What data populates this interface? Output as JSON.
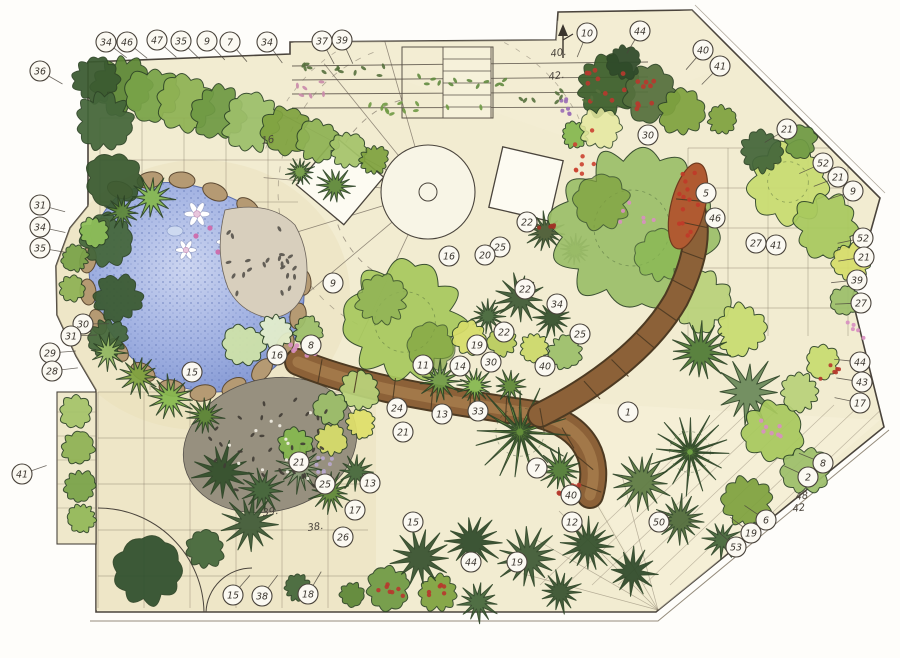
{
  "document": {
    "kind": "hand-drawn watercolor garden landscape plan"
  },
  "colors": {
    "paper": "#fefdfa",
    "plan_paving": "#f2ecd1",
    "sand": "#e9ddb4",
    "ink": "#4a443c",
    "pond_water": "#93a6dc",
    "stone_edging": "#b59a73",
    "pebble_dark": "#403c35",
    "path_brown": "#8c6138",
    "cobble_rust": "#b05a31",
    "foliage_light": "#c9dc71",
    "foliage_mid": "#7fa23f",
    "foliage_dark": "#2f4a2a",
    "flower_red": "#b63a2e",
    "flower_pink": "#d88fc0",
    "flower_purple": "#9b6fb5"
  },
  "features": [
    "pond-with-stone-edging",
    "water-lilies",
    "pebble-mosaic-beds",
    "central-circular-patio",
    "round-table",
    "two-square-platforms",
    "curved-stepping-stone-path",
    "rust-cobble-path",
    "pergola-with-climbers",
    "trellis-panel",
    "garden-gate-swing-arcs",
    "perimeter-planting-beds"
  ],
  "labels": {
    "circled": [
      {
        "n": "34",
        "x": 106,
        "y": 42,
        "e": 1
      },
      {
        "n": "46",
        "x": 127,
        "y": 42,
        "e": 1
      },
      {
        "n": "47",
        "x": 157,
        "y": 40,
        "e": 1
      },
      {
        "n": "35",
        "x": 181,
        "y": 41,
        "e": 1
      },
      {
        "n": "9",
        "x": 207,
        "y": 41,
        "e": 1
      },
      {
        "n": "7",
        "x": 230,
        "y": 42,
        "e": 1
      },
      {
        "n": "34",
        "x": 267,
        "y": 42,
        "e": 1
      },
      {
        "n": "37",
        "x": 322,
        "y": 41,
        "e": 1
      },
      {
        "n": "39",
        "x": 342,
        "y": 40,
        "e": 1
      },
      {
        "n": "10",
        "x": 587,
        "y": 33,
        "e": 1
      },
      {
        "n": "44",
        "x": 640,
        "y": 31,
        "e": 1
      },
      {
        "n": "40",
        "x": 703,
        "y": 50,
        "e": 1
      },
      {
        "n": "41",
        "x": 720,
        "y": 66,
        "e": 1
      },
      {
        "n": "36",
        "x": 40,
        "y": 71,
        "e": 1
      },
      {
        "n": "31",
        "x": 40,
        "y": 205,
        "e": 1
      },
      {
        "n": "34",
        "x": 40,
        "y": 227,
        "e": 1
      },
      {
        "n": "35",
        "x": 40,
        "y": 248,
        "e": 1
      },
      {
        "n": "30",
        "x": 83,
        "y": 324,
        "e": 1
      },
      {
        "n": "31",
        "x": 71,
        "y": 336,
        "e": 1
      },
      {
        "n": "29",
        "x": 50,
        "y": 353,
        "e": 1
      },
      {
        "n": "28",
        "x": 52,
        "y": 371,
        "e": 1
      },
      {
        "n": "41",
        "x": 22,
        "y": 474,
        "e": 1
      },
      {
        "n": "30",
        "x": 648,
        "y": 135
      },
      {
        "n": "21",
        "x": 787,
        "y": 129,
        "e": 1
      },
      {
        "n": "52",
        "x": 823,
        "y": 163,
        "e": 1
      },
      {
        "n": "21",
        "x": 838,
        "y": 177,
        "e": 1
      },
      {
        "n": "9",
        "x": 853,
        "y": 191,
        "e": 1
      },
      {
        "n": "52",
        "x": 863,
        "y": 238,
        "e": 1
      },
      {
        "n": "21",
        "x": 864,
        "y": 257,
        "e": 1
      },
      {
        "n": "39",
        "x": 857,
        "y": 280,
        "e": 1
      },
      {
        "n": "27",
        "x": 861,
        "y": 303,
        "e": 1
      },
      {
        "n": "44",
        "x": 860,
        "y": 362,
        "e": 1
      },
      {
        "n": "43",
        "x": 862,
        "y": 382,
        "e": 1
      },
      {
        "n": "17",
        "x": 860,
        "y": 403,
        "e": 1
      },
      {
        "n": "8",
        "x": 823,
        "y": 463,
        "e": 1
      },
      {
        "n": "2",
        "x": 808,
        "y": 477,
        "e": 1
      },
      {
        "n": "6",
        "x": 766,
        "y": 520,
        "e": 1
      },
      {
        "n": "19",
        "x": 751,
        "y": 533,
        "e": 1
      },
      {
        "n": "53",
        "x": 736,
        "y": 547,
        "e": 1
      },
      {
        "n": "15",
        "x": 233,
        "y": 595,
        "e": 1
      },
      {
        "n": "38",
        "x": 262,
        "y": 596,
        "e": 1
      },
      {
        "n": "18",
        "x": 308,
        "y": 594,
        "e": 1
      },
      {
        "n": "22",
        "x": 527,
        "y": 222
      },
      {
        "n": "25",
        "x": 500,
        "y": 247
      },
      {
        "n": "20",
        "x": 485,
        "y": 255
      },
      {
        "n": "16",
        "x": 449,
        "y": 256
      },
      {
        "n": "9",
        "x": 333,
        "y": 283
      },
      {
        "n": "22",
        "x": 525,
        "y": 289
      },
      {
        "n": "34",
        "x": 557,
        "y": 304
      },
      {
        "n": "25",
        "x": 580,
        "y": 334
      },
      {
        "n": "22",
        "x": 504,
        "y": 332
      },
      {
        "n": "19",
        "x": 477,
        "y": 345
      },
      {
        "n": "8",
        "x": 311,
        "y": 345
      },
      {
        "n": "16",
        "x": 277,
        "y": 355
      },
      {
        "n": "15",
        "x": 192,
        "y": 372
      },
      {
        "n": "11",
        "x": 423,
        "y": 365
      },
      {
        "n": "14",
        "x": 460,
        "y": 366
      },
      {
        "n": "30",
        "x": 491,
        "y": 362
      },
      {
        "n": "40",
        "x": 545,
        "y": 366
      },
      {
        "n": "24",
        "x": 397,
        "y": 408
      },
      {
        "n": "13",
        "x": 442,
        "y": 414
      },
      {
        "n": "33",
        "x": 478,
        "y": 411
      },
      {
        "n": "21",
        "x": 403,
        "y": 432
      },
      {
        "n": "1",
        "x": 628,
        "y": 412
      },
      {
        "n": "21",
        "x": 299,
        "y": 462
      },
      {
        "n": "25",
        "x": 325,
        "y": 484
      },
      {
        "n": "13",
        "x": 370,
        "y": 483
      },
      {
        "n": "17",
        "x": 355,
        "y": 510
      },
      {
        "n": "26",
        "x": 343,
        "y": 537
      },
      {
        "n": "15",
        "x": 413,
        "y": 522
      },
      {
        "n": "44",
        "x": 471,
        "y": 562
      },
      {
        "n": "19",
        "x": 517,
        "y": 562
      },
      {
        "n": "7",
        "x": 537,
        "y": 468
      },
      {
        "n": "40",
        "x": 571,
        "y": 495
      },
      {
        "n": "12",
        "x": 572,
        "y": 522
      },
      {
        "n": "50",
        "x": 659,
        "y": 522
      },
      {
        "n": "5",
        "x": 706,
        "y": 193
      },
      {
        "n": "46",
        "x": 715,
        "y": 218
      },
      {
        "n": "27",
        "x": 756,
        "y": 243
      },
      {
        "n": "41",
        "x": 776,
        "y": 245
      }
    ],
    "handwritten": [
      {
        "n": "48",
        "x": 796,
        "y": 500
      },
      {
        "n": "42",
        "x": 793,
        "y": 512
      },
      {
        "n": "39.",
        "x": 263,
        "y": 516
      },
      {
        "n": "38.",
        "x": 308,
        "y": 531
      },
      {
        "n": "40.",
        "x": 551,
        "y": 57
      },
      {
        "n": "42.",
        "x": 549,
        "y": 80
      },
      {
        "n": "16",
        "x": 262,
        "y": 144
      }
    ]
  }
}
